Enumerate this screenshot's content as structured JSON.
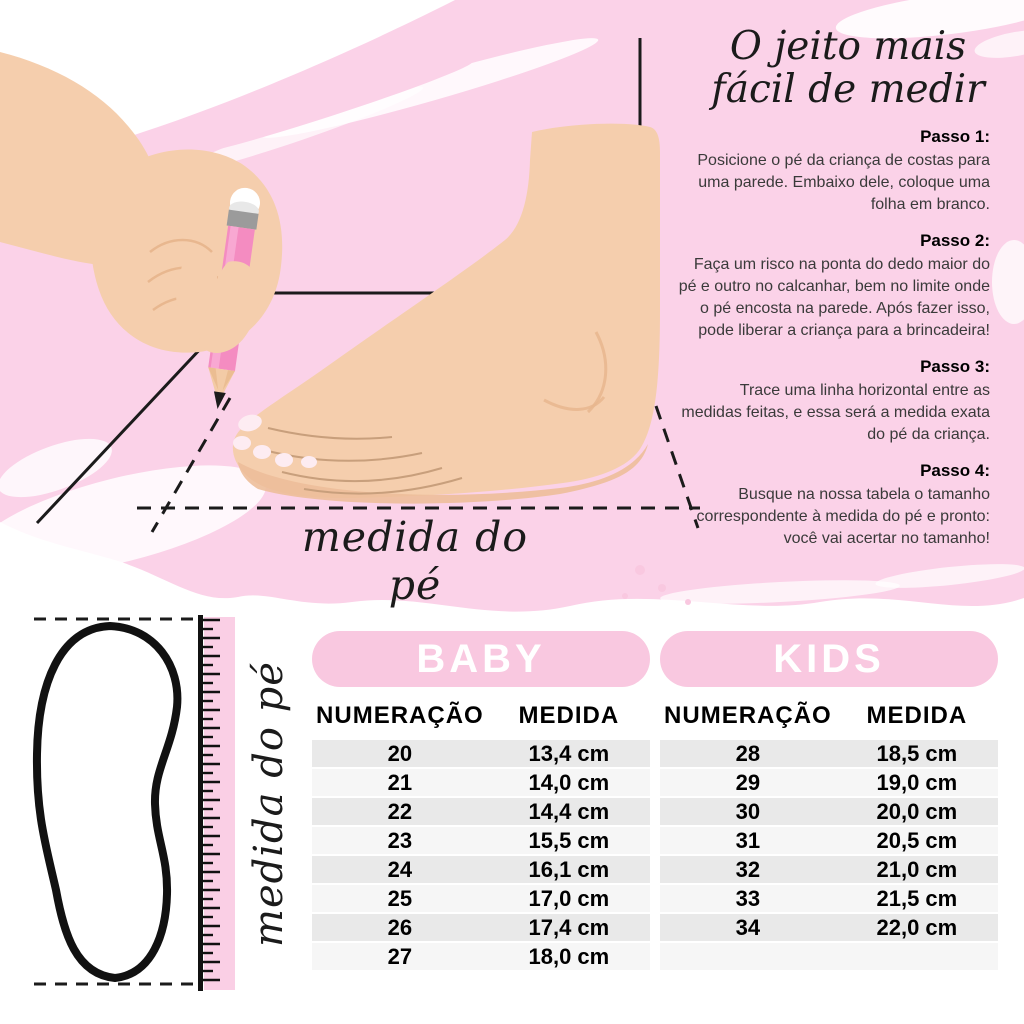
{
  "colors": {
    "background_pink": "#FBD2E8",
    "pill_pink": "#F9C8E0",
    "ruler_band_pink": "#FACFE5",
    "row_dark": "#E9E9E9",
    "row_light": "#F6F6F6",
    "skin": "#F5CEAD",
    "skin_shade": "#EDBE9A",
    "pencil_pink": "#F48CC1",
    "line_black": "#1b1b1b"
  },
  "illustration": {
    "foot_measure_label": "medida do pé"
  },
  "ruler": {
    "label": "medida do pé"
  },
  "guide": {
    "title_line1": "O jeito mais",
    "title_line2": "fácil de medir",
    "steps": [
      {
        "heading": "Passo 1:",
        "body": "Posicione o pé da criança de costas para uma parede. Embaixo dele, coloque uma folha em branco."
      },
      {
        "heading": "Passo 2:",
        "body": "Faça um risco na ponta do dedo maior do pé e outro no calcanhar, bem no limite onde o pé encosta na parede. Após fazer isso, pode liberar a criança para a brincadeira!"
      },
      {
        "heading": "Passo 3:",
        "body": "Trace uma linha horizontal entre as medidas feitas, e essa será a medida exata do pé da criança."
      },
      {
        "heading": "Passo 4:",
        "body": "Busque na nossa tabela o tamanho correspondente à medida do pé e pronto: você vai acertar no tamanho!"
      }
    ]
  },
  "tables": {
    "baby": {
      "title": "BABY",
      "col_size": "NUMERAÇÃO",
      "col_measure": "MEDIDA",
      "rows": [
        {
          "size": "20",
          "measure": "13,4 cm"
        },
        {
          "size": "21",
          "measure": "14,0 cm"
        },
        {
          "size": "22",
          "measure": "14,4 cm"
        },
        {
          "size": "23",
          "measure": "15,5 cm"
        },
        {
          "size": "24",
          "measure": "16,1 cm"
        },
        {
          "size": "25",
          "measure": "17,0 cm"
        },
        {
          "size": "26",
          "measure": "17,4 cm"
        },
        {
          "size": "27",
          "measure": "18,0 cm"
        }
      ]
    },
    "kids": {
      "title": "KIDS",
      "col_size": "NUMERAÇÃO",
      "col_measure": "MEDIDA",
      "rows": [
        {
          "size": "28",
          "measure": "18,5 cm"
        },
        {
          "size": "29",
          "measure": "19,0 cm"
        },
        {
          "size": "30",
          "measure": "20,0 cm"
        },
        {
          "size": "31",
          "measure": "20,5 cm"
        },
        {
          "size": "32",
          "measure": "21,0 cm"
        },
        {
          "size": "33",
          "measure": "21,5 cm"
        },
        {
          "size": "34",
          "measure": "22,0 cm"
        }
      ]
    }
  }
}
